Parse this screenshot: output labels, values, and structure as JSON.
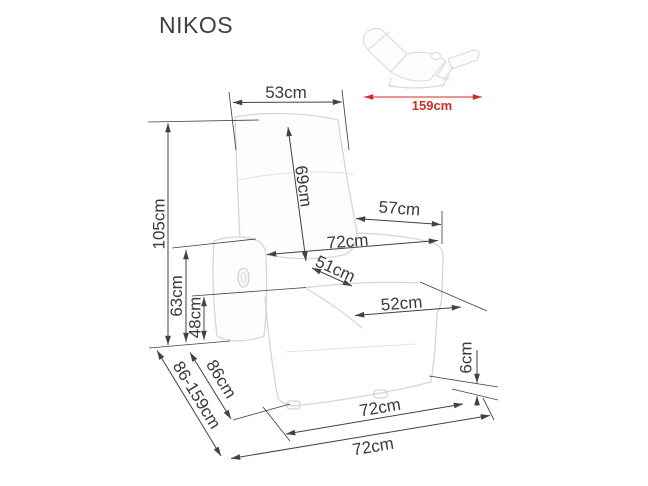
{
  "page": {
    "title": "NIKOS"
  },
  "colors": {
    "background": "#ffffff",
    "dimension_line": "#424242",
    "label_text": "#3a3a3a",
    "chair_outline": "#d6d6d6",
    "accent_red": "#cf2e27"
  },
  "main_diagram": {
    "back_width": "53cm",
    "back_height": "69cm",
    "overall_height": "105cm",
    "upper_seat_width": "57cm",
    "overall_width_upper": "72cm",
    "seat_depth": "51cm",
    "seat_width": "52cm",
    "armrest_height": "63cm",
    "seat_height": "48cm",
    "depth_range": "86-159cm",
    "depth": "86cm",
    "base_clearance": "6cm",
    "base_width": "72cm",
    "overall_width": "72cm"
  },
  "inset_diagram": {
    "reclined_length": "159cm"
  }
}
